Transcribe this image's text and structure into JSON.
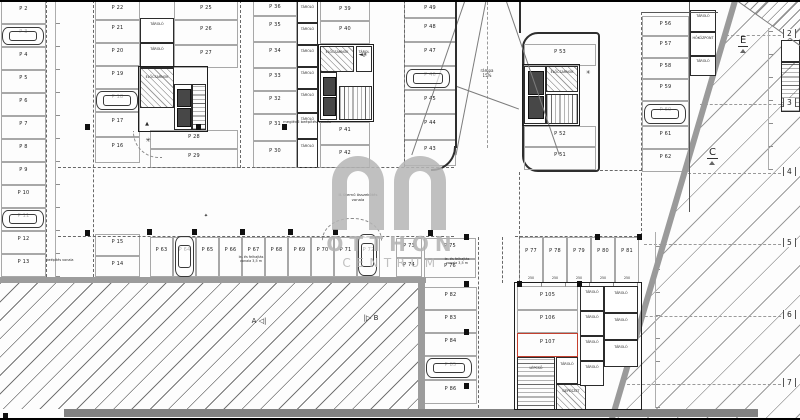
{
  "watermark": {
    "line1": "OTTHON",
    "line2": "CENTRUM"
  },
  "colors": {
    "stall_line": "#a8a8a8",
    "wall": "#2e2e2e",
    "red_highlight": "#c4402f",
    "hatch_gray": "#9c9c9c",
    "watermark_gray": "#b4b4b4",
    "paper": "#fdfdfd"
  },
  "plan": {
    "stalls": [
      [
        "P 2",
        1,
        1,
        45,
        23
      ],
      [
        "P 3",
        1,
        24,
        45,
        23
      ],
      [
        "P 4",
        1,
        47,
        45,
        23
      ],
      [
        "P 5",
        1,
        70,
        45,
        23
      ],
      [
        "P 6",
        1,
        93,
        45,
        23
      ],
      [
        "P 7",
        1,
        116,
        45,
        23
      ],
      [
        "P 8",
        1,
        139,
        45,
        23
      ],
      [
        "P 9",
        1,
        162,
        45,
        23
      ],
      [
        "P 10",
        1,
        185,
        45,
        23
      ],
      [
        "P 11",
        1,
        208,
        45,
        23
      ],
      [
        "P 12",
        1,
        231,
        45,
        23
      ],
      [
        "P 13",
        1,
        254,
        45,
        23
      ],
      [
        "P 22",
        95,
        1,
        45,
        19
      ],
      [
        "P 21",
        95,
        20,
        45,
        23
      ],
      [
        "P 20",
        95,
        43,
        45,
        23
      ],
      [
        "P 19",
        95,
        66,
        45,
        23
      ],
      [
        "P 18",
        95,
        89,
        45,
        23
      ],
      [
        "P 17",
        95,
        112,
        45,
        25
      ],
      [
        "P 16",
        95,
        137,
        45,
        26
      ],
      [
        "P 15",
        95,
        234,
        45,
        22
      ],
      [
        "P 14",
        95,
        256,
        45,
        21
      ],
      [
        "P 25",
        174,
        1,
        64,
        19
      ],
      [
        "P 26",
        174,
        20,
        64,
        25
      ],
      [
        "P 27",
        174,
        45,
        64,
        23
      ],
      [
        "P 28",
        150,
        130,
        88,
        19
      ],
      [
        "P 29",
        150,
        149,
        88,
        19
      ],
      [
        "P 36",
        253,
        1,
        44,
        15
      ],
      [
        "P 35",
        253,
        16,
        44,
        26
      ],
      [
        "P 34",
        253,
        42,
        44,
        26
      ],
      [
        "P 33",
        253,
        68,
        44,
        23
      ],
      [
        "P 32",
        253,
        91,
        44,
        23
      ],
      [
        "P 31",
        253,
        114,
        44,
        27
      ],
      [
        "P 30",
        253,
        141,
        44,
        27
      ],
      [
        "P 39",
        320,
        1,
        50,
        20
      ],
      [
        "P 40",
        320,
        21,
        50,
        23
      ],
      [
        "P 41",
        320,
        122,
        50,
        23
      ],
      [
        "P 42",
        320,
        145,
        50,
        23
      ],
      [
        "P 49",
        404,
        1,
        52,
        17
      ],
      [
        "P 48",
        404,
        18,
        52,
        24
      ],
      [
        "P 47",
        404,
        42,
        52,
        24
      ],
      [
        "P 46",
        404,
        66,
        52,
        24
      ],
      [
        "P 45",
        404,
        90,
        52,
        24
      ],
      [
        "P 44",
        404,
        114,
        52,
        26
      ],
      [
        "P 43",
        404,
        140,
        52,
        26
      ],
      [
        "P 53",
        524,
        44,
        72,
        22
      ],
      [
        "P 52",
        524,
        126,
        72,
        21
      ],
      [
        "P 51",
        524,
        147,
        72,
        23
      ],
      [
        "P 56",
        642,
        16,
        47,
        20
      ],
      [
        "P 57",
        642,
        36,
        47,
        22
      ],
      [
        "P 58",
        642,
        58,
        47,
        21
      ],
      [
        "P 59",
        642,
        79,
        47,
        22
      ],
      [
        "P 60",
        642,
        101,
        47,
        25
      ],
      [
        "P 61",
        642,
        126,
        47,
        23
      ],
      [
        "P 62",
        642,
        149,
        47,
        23
      ],
      [
        "P 63",
        150,
        237,
        23,
        40
      ],
      [
        "P 64",
        173,
        237,
        23,
        40
      ],
      [
        "P 65",
        196,
        237,
        23,
        40
      ],
      [
        "P 66",
        219,
        237,
        23,
        40
      ],
      [
        "P 67",
        242,
        237,
        23,
        40
      ],
      [
        "P 68",
        265,
        237,
        23,
        40
      ],
      [
        "P 69",
        288,
        237,
        23,
        40
      ],
      [
        "P 70",
        311,
        237,
        23,
        40
      ],
      [
        "P 71",
        334,
        237,
        23,
        40
      ],
      [
        "P 72",
        357,
        237,
        23,
        40
      ],
      [
        "P 73",
        396,
        238,
        26,
        20
      ],
      [
        "P 74",
        396,
        258,
        26,
        19
      ],
      [
        "P 75",
        424,
        238,
        52,
        21
      ],
      [
        "P 76",
        424,
        259,
        52,
        19
      ],
      [
        "P 77",
        519,
        237,
        24,
        46
      ],
      [
        "P 78",
        543,
        237,
        24,
        46
      ],
      [
        "P 79",
        567,
        237,
        24,
        46
      ],
      [
        "P 80",
        591,
        237,
        24,
        46
      ],
      [
        "P 81",
        615,
        237,
        24,
        46
      ],
      [
        "P 82",
        424,
        287,
        53,
        23
      ],
      [
        "P 83",
        424,
        310,
        53,
        23
      ],
      [
        "P 84",
        424,
        333,
        53,
        23
      ],
      [
        "P 85",
        424,
        356,
        53,
        24
      ],
      [
        "P 86",
        424,
        380,
        53,
        24
      ],
      [
        "P 105",
        517,
        286,
        61,
        24
      ],
      [
        "P 106",
        517,
        310,
        61,
        23
      ],
      [
        "P 107",
        517,
        333,
        61,
        24,
        1
      ]
    ],
    "cars": [
      [
        2,
        27,
        42,
        18
      ],
      [
        2,
        210,
        42,
        18
      ],
      [
        96,
        91,
        42,
        19
      ],
      [
        406,
        69,
        44,
        19
      ],
      [
        644,
        104,
        42,
        20
      ],
      [
        426,
        358,
        46,
        20
      ],
      [
        175,
        236,
        19,
        41
      ],
      [
        358,
        234,
        19,
        42
      ]
    ],
    "rooms": [
      [
        "plain",
        "TÁROLÓ",
        140,
        18,
        34,
        25
      ],
      [
        "plain",
        "TÁROLÓ",
        140,
        43,
        34,
        25
      ],
      [
        "hatch",
        "ELŐCSARNOK",
        140,
        68,
        34,
        40
      ],
      [
        "lift",
        "",
        174,
        84,
        18,
        46
      ],
      [
        "stairH",
        "",
        192,
        84,
        14,
        46
      ],
      [
        "outline",
        "",
        138,
        66,
        70,
        66
      ],
      [
        "hatch",
        "ELŐCSARNOK",
        320,
        46,
        34,
        26
      ],
      [
        "lift",
        "",
        320,
        72,
        17,
        48
      ],
      [
        "stairV",
        "",
        339,
        86,
        33,
        34
      ],
      [
        "plain",
        "TÁROLÓ",
        356,
        46,
        16,
        26
      ],
      [
        "outline",
        "",
        318,
        44,
        56,
        78
      ],
      [
        "lift",
        "",
        524,
        66,
        22,
        58
      ],
      [
        "hatch",
        "ELŐCSARNOK",
        546,
        66,
        32,
        26
      ],
      [
        "stairV",
        "",
        546,
        94,
        32,
        30
      ],
      [
        "outline",
        "",
        522,
        64,
        58,
        62
      ],
      [
        "plain",
        "TÁROLÓ",
        297,
        1,
        21,
        22
      ],
      [
        "plain",
        "TÁROLÓ",
        297,
        23,
        21,
        22
      ],
      [
        "plain",
        "TÁROLÓ",
        297,
        45,
        21,
        22
      ],
      [
        "plain",
        "TÁROLÓ",
        297,
        67,
        21,
        22
      ],
      [
        "plain",
        "TÁROLÓ",
        297,
        89,
        21,
        24
      ],
      [
        "plain",
        "TÁROLÓ",
        297,
        113,
        21,
        26
      ],
      [
        "plain",
        "TÁROLÓ",
        297,
        139,
        21,
        29
      ],
      [
        "plain",
        "TÁROLÓ",
        690,
        10,
        26,
        22
      ],
      [
        "plain",
        "HŐKÖZPONT",
        690,
        32,
        26,
        24
      ],
      [
        "plain",
        "TÁROLÓ",
        690,
        56,
        26,
        20
      ],
      [
        "stairH",
        "LÉPCSŐ",
        517,
        357,
        38,
        54
      ],
      [
        "plain",
        "TÁROLÓ",
        556,
        357,
        22,
        27
      ],
      [
        "hatch",
        "GÉPÉSZET",
        556,
        384,
        30,
        27
      ],
      [
        "plain",
        "TÁROLÓ",
        580,
        286,
        24,
        25
      ],
      [
        "plain",
        "TÁROLÓ",
        580,
        311,
        24,
        25
      ],
      [
        "plain",
        "TÁROLÓ",
        580,
        336,
        24,
        25
      ],
      [
        "plain",
        "TÁROLÓ",
        580,
        361,
        24,
        25
      ],
      [
        "plain",
        "TÁROLÓ",
        604,
        286,
        34,
        27
      ],
      [
        "plain",
        "TÁROLÓ",
        604,
        313,
        34,
        27
      ],
      [
        "plain",
        "TÁROLÓ",
        604,
        340,
        34,
        27
      ],
      [
        "outline",
        "",
        514,
        282,
        128,
        128
      ],
      [
        "stairH",
        "",
        781,
        62,
        19,
        50
      ],
      [
        "plain",
        "",
        781,
        40,
        19,
        22
      ]
    ],
    "lines": [
      [
        "hd",
        58,
        167,
        396
      ],
      [
        "hd",
        58,
        236,
        396
      ],
      [
        "hd",
        600,
        170,
        42
      ],
      [
        "hd",
        515,
        236,
        127
      ],
      [
        "vd",
        46,
        0,
        277
      ],
      [
        "vd",
        93,
        0,
        277
      ],
      [
        "vd",
        240,
        0,
        168
      ],
      [
        "vd",
        404,
        0,
        167
      ],
      [
        "vd",
        478,
        237,
        171
      ],
      [
        "vd",
        502,
        237,
        46
      ],
      [
        "vd",
        519,
        172,
        111
      ],
      [
        "vd",
        641,
        12,
        224
      ],
      [
        "vs",
        689,
        2,
        210
      ],
      [
        "vdd",
        487,
        2,
        146
      ],
      [
        "hdd",
        726,
        35,
        60
      ],
      [
        "hdd",
        700,
        104,
        86
      ],
      [
        "hdd",
        688,
        173,
        98
      ],
      [
        "hdd",
        644,
        244,
        142
      ],
      [
        "hdd",
        630,
        316,
        156
      ],
      [
        "hdd",
        622,
        384,
        164
      ],
      [
        "dimv",
        55,
        0,
        277
      ],
      [
        "dimv",
        655,
        232,
        176
      ],
      [
        "dimv",
        768,
        28,
        142
      ],
      [
        "dimh",
        517,
        282,
        124
      ],
      [
        "hs",
        642,
        12,
        76
      ]
    ],
    "rots": [
      [
        "v",
        466,
        -4,
        168,
        19
      ],
      [
        "v",
        504,
        -4,
        168,
        -19
      ],
      [
        "v",
        486,
        -2,
        160,
        11
      ],
      [
        "h",
        457,
        86,
        66,
        20
      ],
      [
        "h",
        737,
        0,
        78,
        35.5
      ]
    ],
    "columns": [
      [
        85,
        124
      ],
      [
        196,
        124
      ],
      [
        282,
        124
      ],
      [
        85,
        230
      ],
      [
        147,
        229
      ],
      [
        192,
        229
      ],
      [
        240,
        229
      ],
      [
        288,
        229
      ],
      [
        333,
        229
      ],
      [
        428,
        230
      ],
      [
        464,
        234
      ],
      [
        464,
        281
      ],
      [
        464,
        329
      ],
      [
        464,
        383
      ],
      [
        595,
        234
      ],
      [
        637,
        234
      ],
      [
        517,
        281
      ],
      [
        577,
        281
      ],
      [
        3,
        413
      ]
    ],
    "grid_bubbles": [
      [
        "2",
        35
      ],
      [
        "3",
        104
      ],
      [
        "4",
        173
      ],
      [
        "5",
        244
      ],
      [
        "6",
        316
      ],
      [
        "7",
        384
      ]
    ],
    "section_markers": [
      [
        "E",
        738,
        28
      ],
      [
        "C",
        707,
        140
      ]
    ],
    "annotations": [
      [
        "meglévő beépítés vonala",
        252,
        120,
        110,
        3.8
      ],
      [
        "beépítés vonala",
        30,
        258,
        60,
        3.4
      ],
      [
        "le- és felhajtás\nvonala 3,5 m",
        222,
        255,
        58,
        3.4
      ],
      [
        "le- és felhajtás\nvonala 3,5 m",
        428,
        257,
        58,
        3.4
      ],
      [
        "II. ütemű összekötés\nvonala",
        316,
        193,
        84,
        3.8
      ],
      [
        "rámpa\n15%",
        472,
        68,
        30,
        4
      ],
      [
        "250",
        523,
        276,
        16,
        3.2
      ],
      [
        "250",
        547,
        276,
        16,
        3.2
      ],
      [
        "250",
        571,
        276,
        16,
        3.2
      ],
      [
        "250",
        595,
        276,
        16,
        3.2
      ],
      [
        "250",
        619,
        276,
        16,
        3.2
      ],
      [
        "✳",
        143,
        137,
        10,
        6
      ],
      [
        "▲",
        142,
        121,
        10,
        5
      ],
      [
        "◄✳",
        355,
        52,
        16,
        5.5
      ],
      [
        "✳",
        583,
        70,
        10,
        5.5
      ],
      [
        "✦",
        201,
        213,
        10,
        5
      ],
      [
        "A ◁|",
        246,
        317,
        26,
        7
      ],
      [
        "|▷ B",
        358,
        314,
        26,
        7
      ]
    ]
  }
}
